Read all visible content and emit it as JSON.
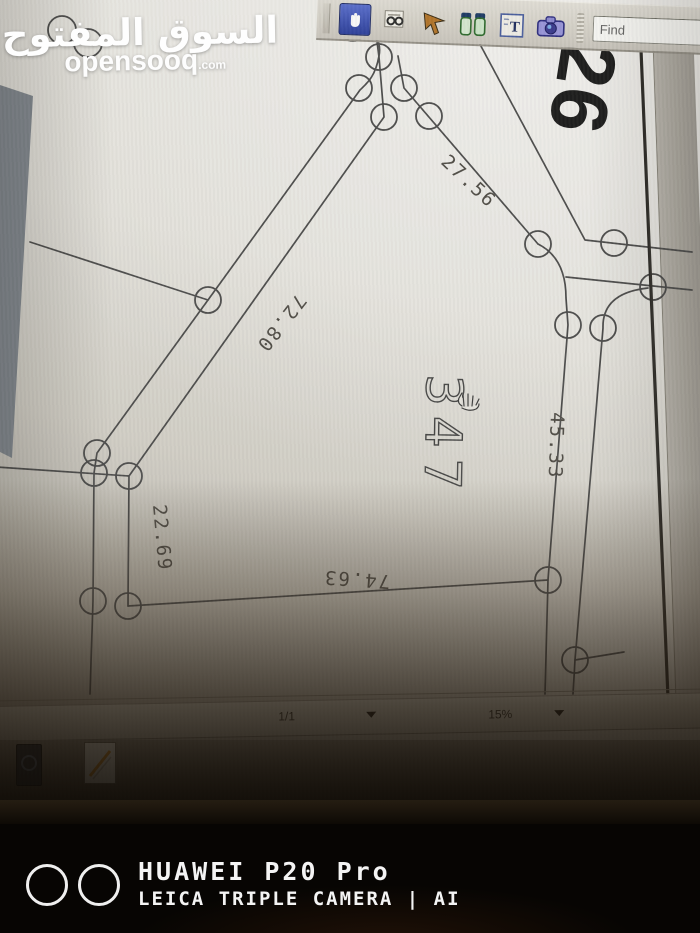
{
  "opensooq_watermark": {
    "arabic_name": "السوق المفتوح",
    "site_name": "opensooq",
    "site_tld": ".com"
  },
  "toolbar": {
    "find_placeholder": "Find",
    "icons": [
      "hand-tool",
      "select-text-tool",
      "arrow-cursor-tool",
      "zoom-tools",
      "text-tool",
      "snapshot-camera-tool"
    ]
  },
  "document": {
    "sheet_number": "26",
    "plot_number": "347",
    "measurements": {
      "northeast_side": "27.56",
      "northwest_side": "72.80",
      "east_side": "45.33",
      "west_side": "22.69",
      "south_side": "74.63"
    }
  },
  "statusbar": {
    "page_indicator": "1/1",
    "zoom_percent": "15%"
  },
  "photo_watermark": {
    "device_name": "HUAWEI P20 Pro",
    "camera_info": "LEICA TRIPLE CAMERA | AI"
  }
}
